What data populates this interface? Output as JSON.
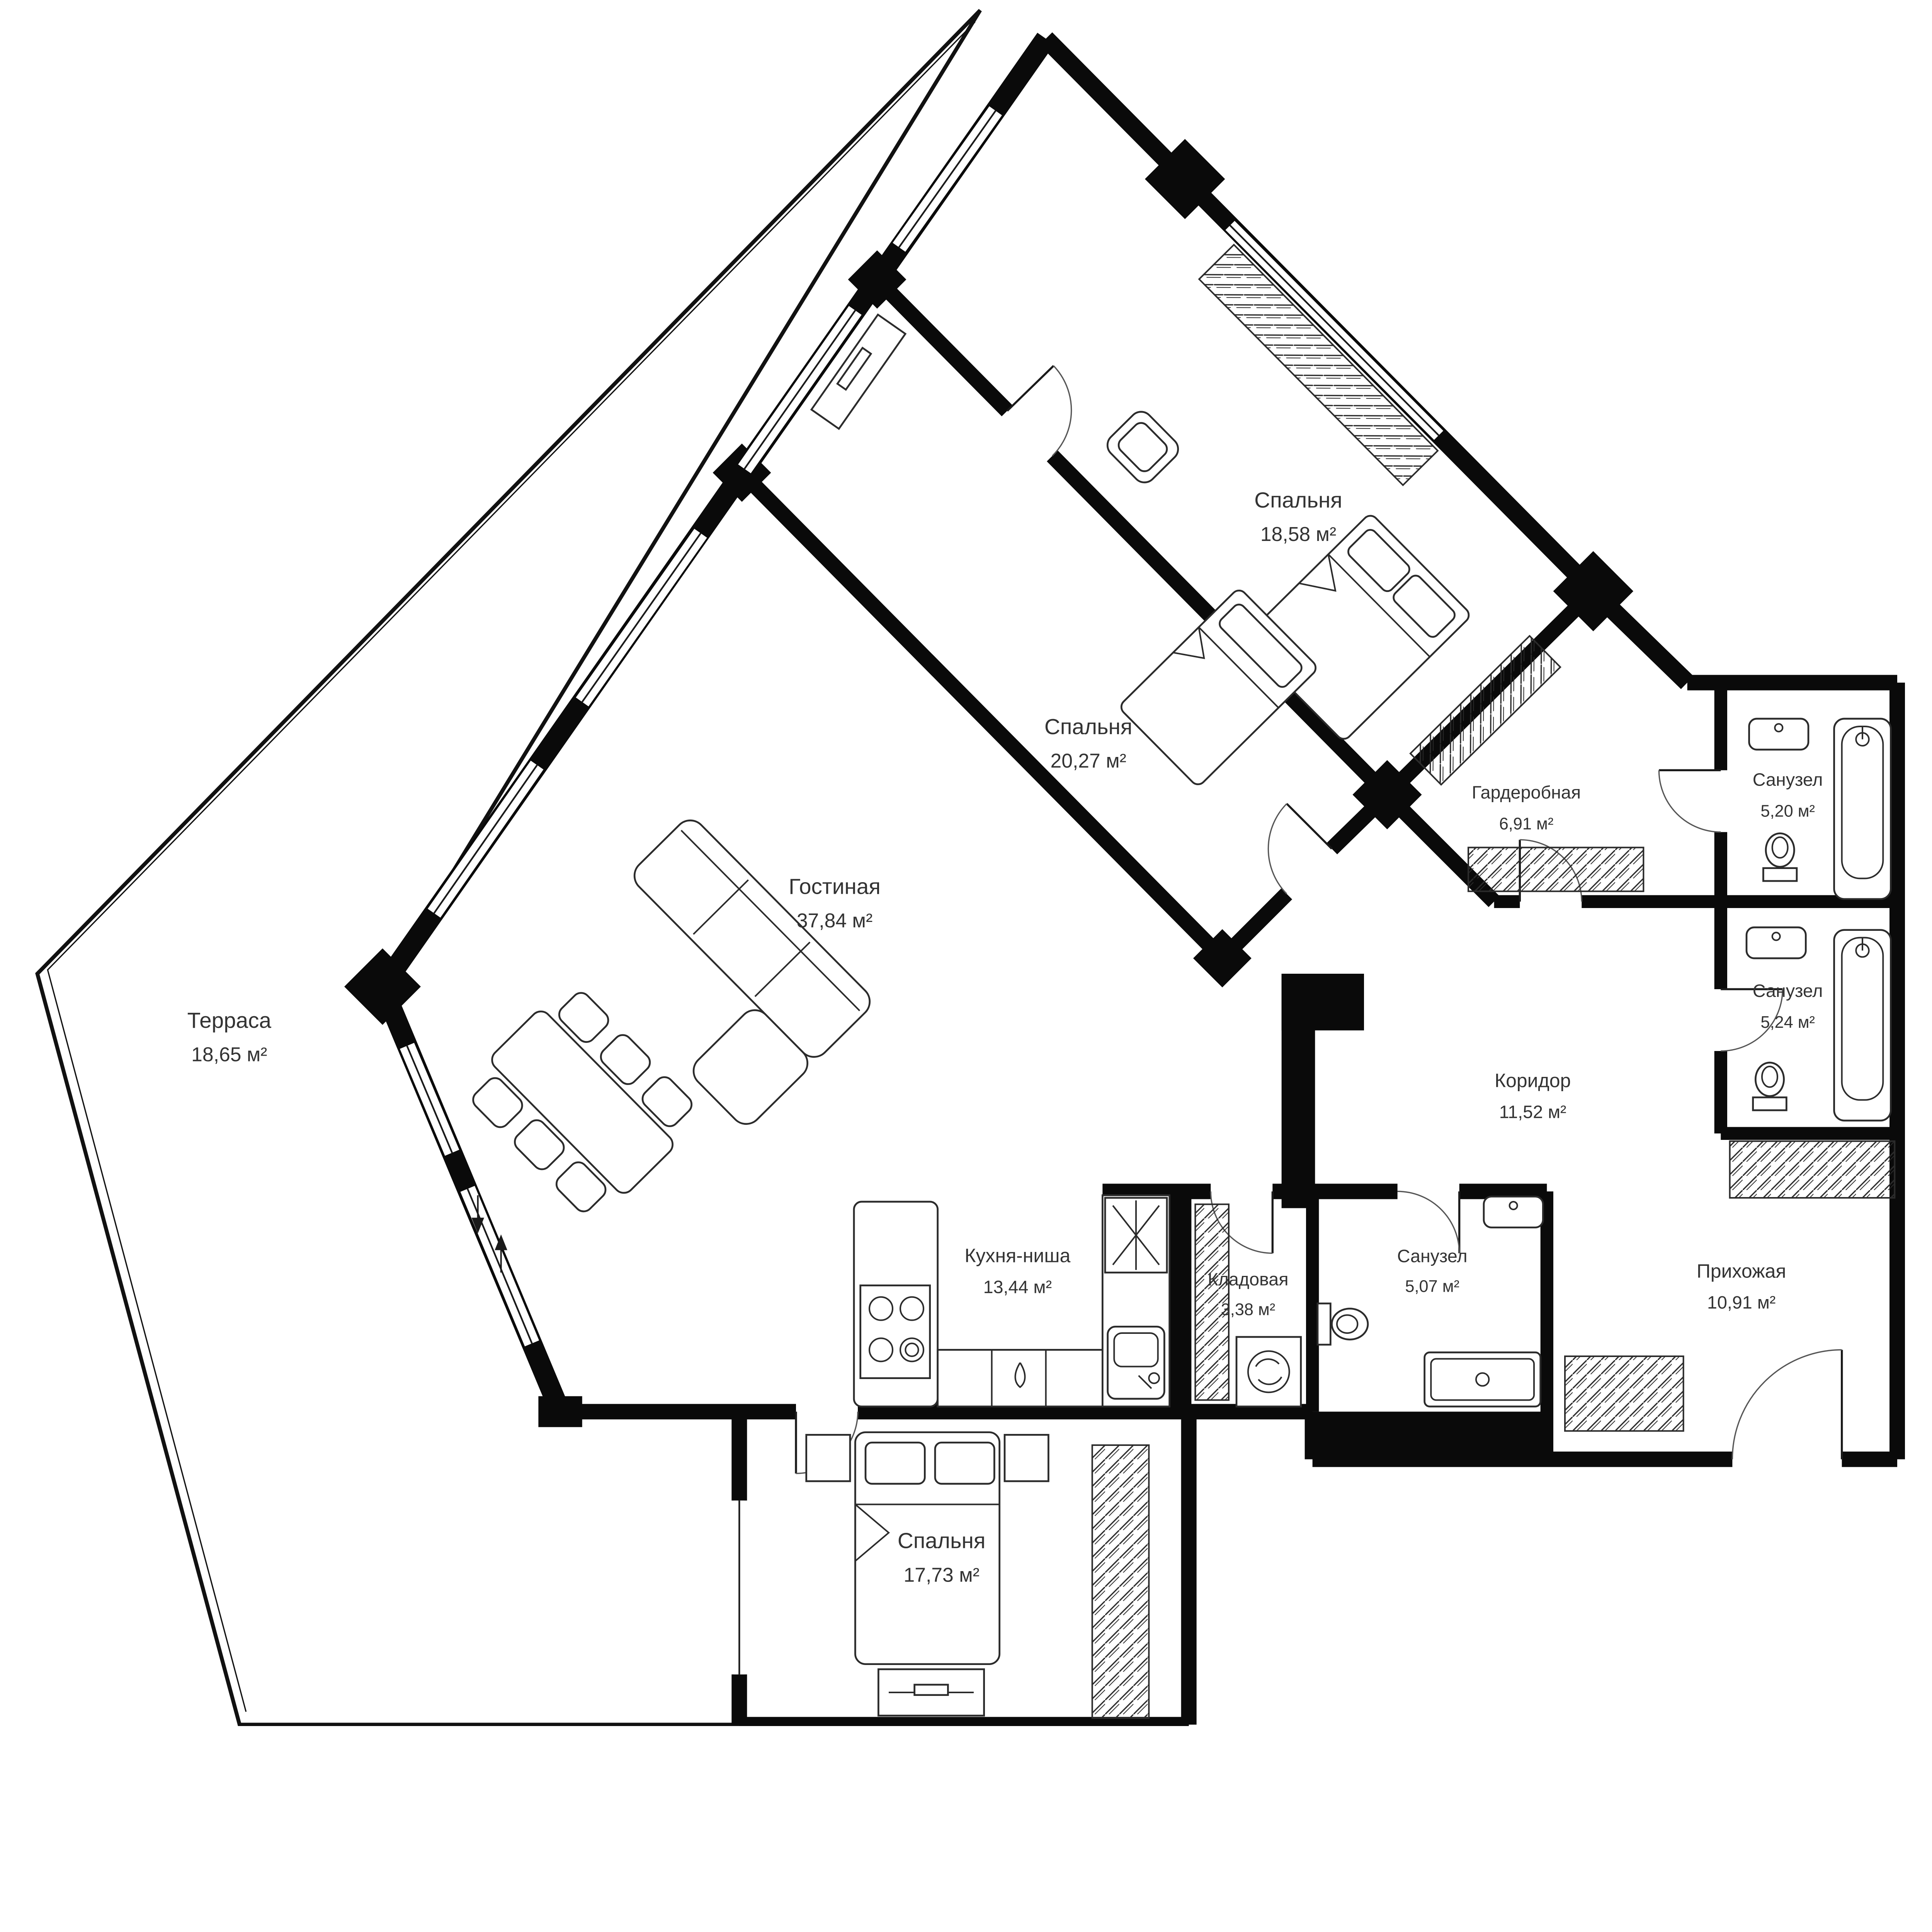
{
  "rooms": [
    {
      "id": "terrace",
      "name": "Терраса",
      "area": "18,65 м²"
    },
    {
      "id": "living",
      "name": "Гостиная",
      "area": "37,84 м²"
    },
    {
      "id": "bedroom-1",
      "name": "Спальня",
      "area": "18,58 м²"
    },
    {
      "id": "bedroom-2",
      "name": "Спальня",
      "area": "20,27 м²"
    },
    {
      "id": "wardrobe",
      "name": "Гардеробная",
      "area": "6,91 м²"
    },
    {
      "id": "bath-1",
      "name": "Санузел",
      "area": "5,20 м²"
    },
    {
      "id": "bath-2",
      "name": "Санузел",
      "area": "5,24 м²"
    },
    {
      "id": "corridor",
      "name": "Коридор",
      "area": "11,52 м²"
    },
    {
      "id": "kitchen",
      "name": "Кухня-ниша",
      "area": "13,44 м²"
    },
    {
      "id": "storage",
      "name": "Кладовая",
      "area": "3,38 м²"
    },
    {
      "id": "bath-3",
      "name": "Санузел",
      "area": "5,07 м²"
    },
    {
      "id": "hallway",
      "name": "Прихожая",
      "area": "10,91 м²"
    },
    {
      "id": "bedroom-3",
      "name": "Спальня",
      "area": "17,73 м²"
    }
  ],
  "colors": {
    "walls": "#0a0a0a",
    "background": "#ffffff",
    "text": "#333333"
  }
}
